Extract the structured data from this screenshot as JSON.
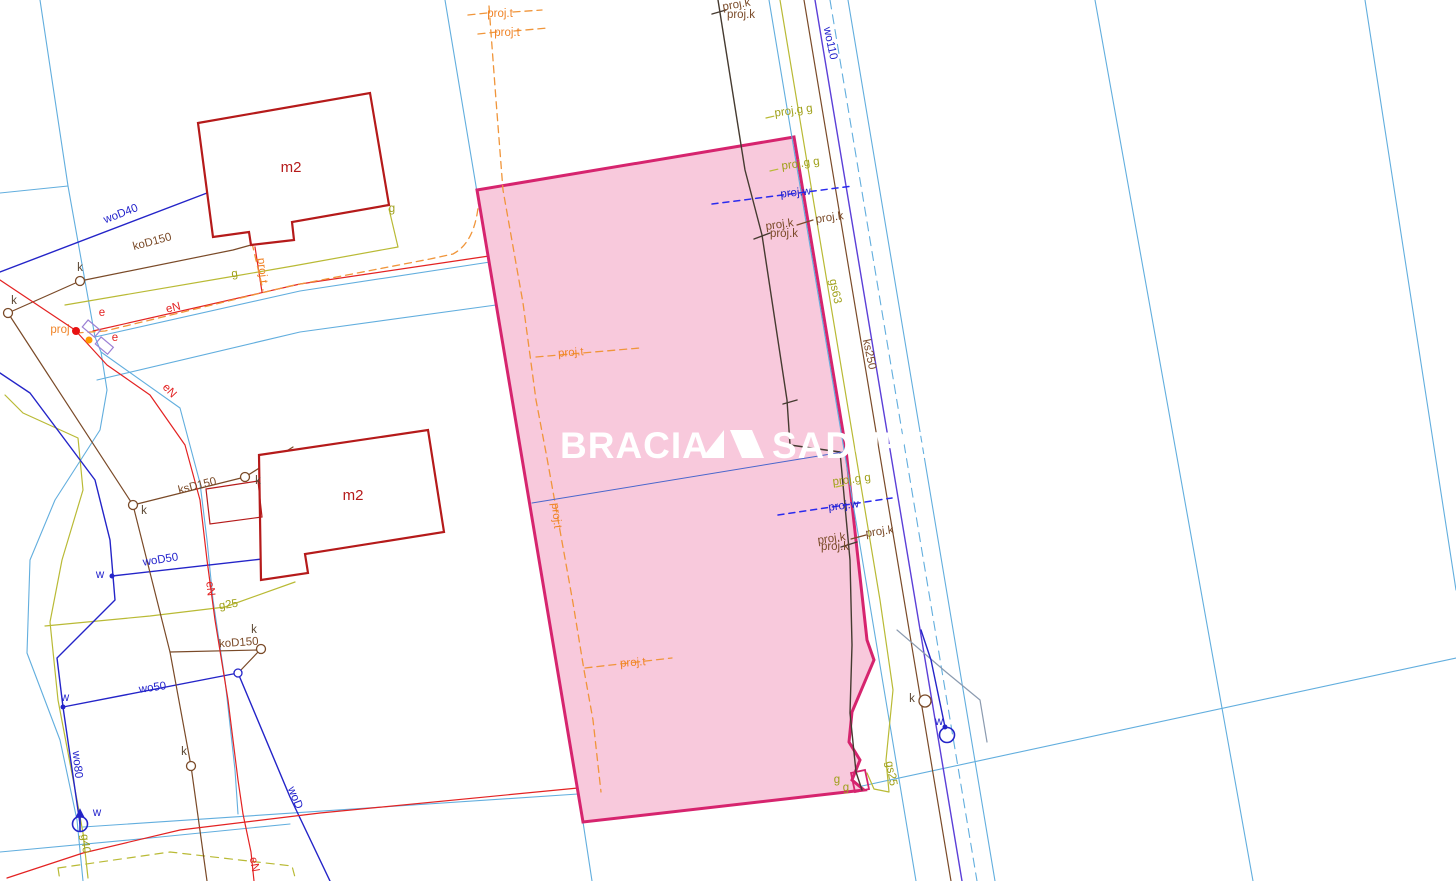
{
  "watermark": {
    "part1": "BRACIA",
    "part2": "SADURSCY"
  },
  "colors": {
    "plot_fill": "#f8c9dc",
    "plot_border": "#d6246e",
    "parcel_line": "#62aede",
    "water_line": "#2424c8",
    "gas_line": "#b9ba35",
    "sewer_line": "#7a4a28",
    "power_line": "#e32222",
    "projected_t_line": "#f0953a",
    "projected_w_line": "#2a2aee",
    "building": "#b51a1a"
  },
  "labels": {
    "proj_t_top1": "proj.t",
    "proj_t_top2": "proj.t",
    "proj_k_top1": "proj.k",
    "proj_k_top2": "proj.k",
    "wo110": "wo110",
    "proj_g_1": "proj.g g",
    "proj_g_2": "proj.g g",
    "proj_g_3": "proj.g g",
    "proj_w_1": "proj.w",
    "proj_w_2": "proj.w",
    "proj_k_a1": "proj.k",
    "proj_k_a2": "proj.k",
    "proj_k_a3": "proj.k",
    "proj_k_b1": "proj.k",
    "proj_k_b2": "proj.k",
    "proj_k_b3": "proj.k",
    "gs63": "gs63",
    "ks250": "ks250",
    "gs25": "gs25",
    "woD40": "woD40",
    "woD50": "woD50",
    "wo50": "wo50",
    "wo80": "wo80",
    "woD": "woD",
    "koD150_1": "koD150",
    "koD150_2": "koD150",
    "ksD150": "ksD150",
    "g25": "g25",
    "g40": "g40",
    "g_1": "g",
    "g_2": "g",
    "g_3": "g",
    "g_bld": "g",
    "proj": "proj",
    "proj_t_rot": "proj.t",
    "proj_t_in1": "proj.t",
    "proj_t_in2": "proj.t",
    "proj_t_vert": "proj.t",
    "eN_1": "eN",
    "eN_2": "eN",
    "eN_3": "eN",
    "eN_4": "eN",
    "e_1": "e",
    "e_2": "e",
    "k_1": "k",
    "k_2": "k",
    "k_3": "k",
    "k_4": "k",
    "k_5": "k",
    "k_6": "k",
    "k_7": "k",
    "w_1": "w",
    "w_2": "w",
    "w_3": "w",
    "w_4": "w",
    "m2_1": "m2",
    "m2_2": "m2"
  }
}
